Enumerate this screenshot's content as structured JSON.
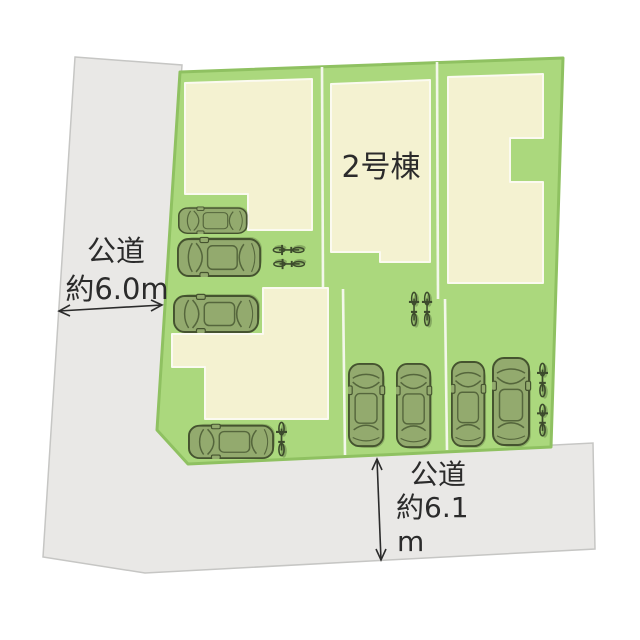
{
  "labels": {
    "unit_label": "2号棟",
    "left_road": {
      "name": "公道",
      "width": "約6.0m"
    },
    "bottom_road": {
      "name": "公道",
      "width_line1": "約6.1",
      "width_line2": "m"
    }
  },
  "colors": {
    "background": "#ffffff",
    "lot_green": "#abd87d",
    "lot_border_green": "#8fc161",
    "building_fill": "#f4f2d1",
    "building_border": "#fbfaf0",
    "road_fill": "#e9e8e6",
    "road_border": "#c6c6c4",
    "parcel_divider": "#f3f7ea",
    "vehicle_fill": "#93aa6e",
    "vehicle_outline": "#45532f",
    "text": "#2b2b2b"
  },
  "objects": {
    "building_count": 4,
    "car_count": 8,
    "bicycle_count": 7
  }
}
